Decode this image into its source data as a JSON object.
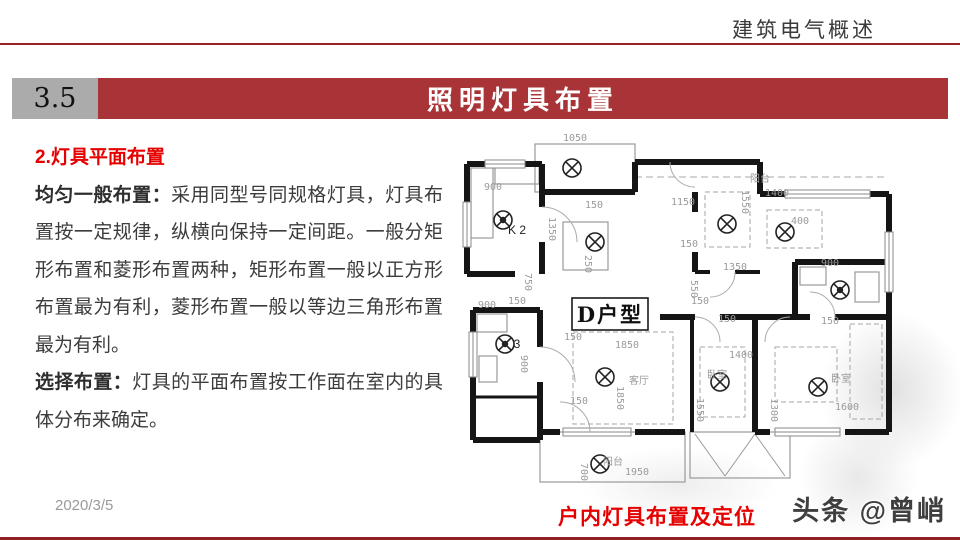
{
  "header": {
    "title": "建筑电气概述"
  },
  "section": {
    "number": "3.5",
    "title": "照明灯具布置"
  },
  "content": {
    "heading": "2.灯具平面布置",
    "paragraphs": [
      {
        "label": "均匀一般布置：",
        "text": "采用同型号同规格灯具，灯具布置按一定规律，纵横向保持一定间距。一般分矩形布置和菱形布置两种，矩形布置一般以正方形布置最为有利，菱形布置一般以等边三角形布置最为有利。"
      },
      {
        "label": "选择布置：",
        "text": "灯具的平面布置按工作面在室内的具体分布来确定。"
      }
    ]
  },
  "floorplan": {
    "unit_label": "D户型",
    "caption": "户内灯具布置及定位",
    "unit_box": [
      117,
      166,
      76,
      32
    ],
    "walls": [
      [
        12,
        32,
        87,
        32
      ],
      [
        12,
        32,
        12,
        142
      ],
      [
        87,
        32,
        87,
        75
      ],
      [
        87,
        110,
        87,
        142
      ],
      [
        12,
        142,
        60,
        142
      ],
      [
        18,
        178,
        85,
        178
      ],
      [
        18,
        178,
        18,
        308
      ],
      [
        85,
        178,
        85,
        215
      ],
      [
        85,
        250,
        85,
        308
      ],
      [
        18,
        265,
        85,
        265,
        3
      ],
      [
        18,
        308,
        85,
        308
      ],
      [
        87,
        60,
        180,
        60
      ],
      [
        180,
        30,
        180,
        60
      ],
      [
        180,
        30,
        305,
        30
      ],
      [
        305,
        30,
        305,
        62
      ],
      [
        305,
        62,
        330,
        62
      ],
      [
        415,
        62,
        434,
        62
      ],
      [
        434,
        62,
        434,
        100
      ],
      [
        434,
        160,
        434,
        300
      ],
      [
        300,
        300,
        315,
        300
      ],
      [
        390,
        300,
        434,
        300
      ],
      [
        85,
        300,
        105,
        300
      ],
      [
        180,
        300,
        230,
        300
      ],
      [
        240,
        60,
        240,
        80
      ],
      [
        240,
        120,
        240,
        140
      ],
      [
        240,
        140,
        255,
        140,
        4
      ],
      [
        280,
        140,
        305,
        140,
        4
      ],
      [
        205,
        185,
        240,
        185
      ],
      [
        265,
        185,
        305,
        185
      ],
      [
        305,
        185,
        355,
        185
      ],
      [
        380,
        185,
        434,
        185
      ],
      [
        237,
        185,
        237,
        300,
        4
      ],
      [
        300,
        185,
        300,
        300
      ],
      [
        340,
        130,
        434,
        130
      ],
      [
        340,
        130,
        340,
        185
      ]
    ],
    "windows": [
      [
        30,
        28,
        40,
        8
      ],
      [
        8,
        70,
        8,
        45
      ],
      [
        330,
        58,
        85,
        8
      ],
      [
        430,
        100,
        8,
        60
      ],
      [
        320,
        296,
        65,
        8
      ],
      [
        108,
        296,
        68,
        8
      ],
      [
        14,
        200,
        8,
        45
      ]
    ],
    "thin_rects": [
      [
        80,
        12,
        100,
        48
      ],
      [
        85,
        300,
        145,
        50
      ],
      [
        235,
        300,
        100,
        46
      ],
      [
        16,
        36,
        22,
        70
      ],
      [
        40,
        34,
        44,
        18
      ],
      [
        108,
        90,
        45,
        48
      ],
      [
        22,
        182,
        30,
        18
      ],
      [
        24,
        224,
        18,
        26
      ],
      [
        345,
        135,
        26,
        18
      ],
      [
        400,
        140,
        24,
        30
      ]
    ],
    "dashed_rects": [
      [
        118,
        200,
        100,
        92
      ],
      [
        250,
        60,
        45,
        55
      ],
      [
        312,
        78,
        55,
        38
      ],
      [
        245,
        215,
        45,
        70
      ],
      [
        320,
        215,
        62,
        55
      ],
      [
        395,
        192,
        32,
        95
      ]
    ],
    "thin_lines": [
      [
        240,
        302,
        270,
        344
      ],
      [
        270,
        344,
        300,
        302
      ],
      [
        300,
        302,
        330,
        344
      ]
    ],
    "dash_lines": [
      [
        180,
        45,
        430,
        45
      ]
    ],
    "door_arcs": [
      "M87,75 A35,35 0 0,1 122,110",
      "M215,30 A25,25 0 0,0 240,55",
      "M280,140 A25,25 0 0,1 255,165",
      "M240,185 A25,25 0 0,1 265,210",
      "M335,185 A25,25 0 0,0 310,210",
      "M380,185 A25,25 0 0,0 355,160",
      "M85,215 A35,35 0 0,1 120,250",
      "M105,270 A30,30 0 0,1 135,300"
    ],
    "lamps": [
      [
        117,
        36,
        0
      ],
      [
        48,
        88,
        1
      ],
      [
        140,
        110,
        0
      ],
      [
        272,
        92,
        0
      ],
      [
        330,
        100,
        0
      ],
      [
        385,
        158,
        1
      ],
      [
        50,
        212,
        1
      ],
      [
        150,
        245,
        0
      ],
      [
        265,
        250,
        0
      ],
      [
        363,
        255,
        0
      ],
      [
        145,
        332,
        0
      ]
    ],
    "labels": [
      {
        "t": "1050",
        "x": 120,
        "y": 9
      },
      {
        "t": "900",
        "x": 38,
        "y": 58
      },
      {
        "t": "1350",
        "x": 94,
        "y": 97,
        "r": 90
      },
      {
        "t": "150",
        "x": 139,
        "y": 76
      },
      {
        "t": "250",
        "x": 130,
        "y": 132,
        "r": 90
      },
      {
        "t": "1150",
        "x": 228,
        "y": 73
      },
      {
        "t": "1550",
        "x": 287,
        "y": 70,
        "r": 90
      },
      {
        "t": "阳台",
        "x": 305,
        "y": 50,
        "c": "room"
      },
      {
        "t": "1400",
        "x": 322,
        "y": 64
      },
      {
        "t": "400",
        "x": 345,
        "y": 92
      },
      {
        "t": "150",
        "x": 234,
        "y": 115
      },
      {
        "t": "1350",
        "x": 280,
        "y": 138
      },
      {
        "t": "550",
        "x": 236,
        "y": 157,
        "r": 90
      },
      {
        "t": "150",
        "x": 245,
        "y": 172
      },
      {
        "t": "900",
        "x": 375,
        "y": 134
      },
      {
        "t": "750",
        "x": 70,
        "y": 150,
        "r": 90
      },
      {
        "t": "900",
        "x": 32,
        "y": 176
      },
      {
        "t": "150",
        "x": 62,
        "y": 172
      },
      {
        "t": "900",
        "x": 66,
        "y": 232,
        "r": 90
      },
      {
        "t": "150",
        "x": 118,
        "y": 208
      },
      {
        "t": "1850",
        "x": 172,
        "y": 216
      },
      {
        "t": "客厅",
        "x": 184,
        "y": 252,
        "c": "room"
      },
      {
        "t": "1850",
        "x": 162,
        "y": 266,
        "r": 90
      },
      {
        "t": "150",
        "x": 124,
        "y": 272
      },
      {
        "t": "150",
        "x": 272,
        "y": 190
      },
      {
        "t": "1400",
        "x": 286,
        "y": 226
      },
      {
        "t": "卧室",
        "x": 262,
        "y": 246,
        "c": "room"
      },
      {
        "t": "1550",
        "x": 242,
        "y": 278,
        "r": 90
      },
      {
        "t": "150",
        "x": 375,
        "y": 192
      },
      {
        "t": "卧室",
        "x": 386,
        "y": 250,
        "c": "room"
      },
      {
        "t": "1600",
        "x": 392,
        "y": 278
      },
      {
        "t": "1300",
        "x": 316,
        "y": 278,
        "r": 90
      },
      {
        "t": "700",
        "x": 126,
        "y": 340,
        "r": 90
      },
      {
        "t": "阳台",
        "x": 158,
        "y": 333,
        "c": "room"
      },
      {
        "t": "1950",
        "x": 182,
        "y": 343
      },
      {
        "t": "K 2",
        "x": 62,
        "y": 102,
        "c": "k"
      },
      {
        "t": "3",
        "x": 62,
        "y": 216,
        "c": "k"
      }
    ]
  },
  "footer": {
    "date": "2020/3/5",
    "watermark": "头条 @曾峭"
  },
  "colors": {
    "accent_bar": "#A93437",
    "rule_red": "#9E2123",
    "bottom_red": "#8E1F22",
    "gray_box": "#ABABAB",
    "heading_red": "#e60000",
    "dim_gray": "#9b9b9b"
  }
}
